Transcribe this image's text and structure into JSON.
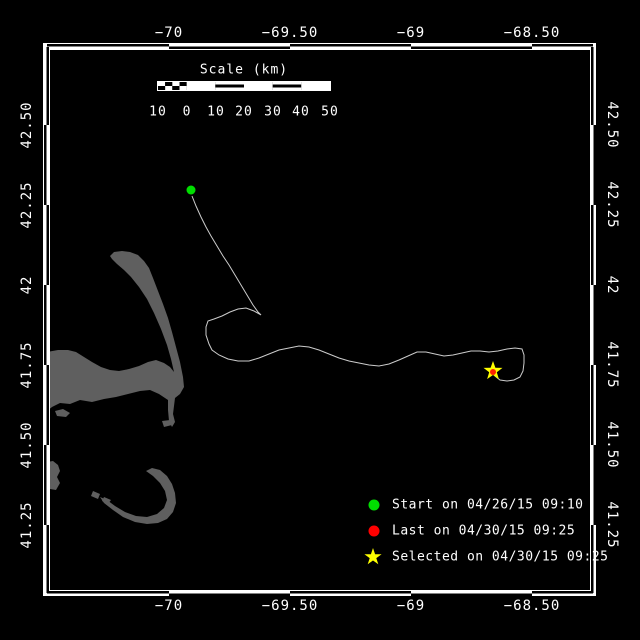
{
  "axes": {
    "lon_labels": [
      "−70",
      "−69.50",
      "−69",
      "−68.50"
    ],
    "lat_labels": [
      "42.50",
      "42.25",
      "42",
      "41.75",
      "41.50",
      "41.25"
    ]
  },
  "scale_bar": {
    "title": "Scale (km)",
    "tick_labels": [
      "10",
      "0",
      "10",
      "20",
      "30",
      "40",
      "50"
    ]
  },
  "legend": {
    "items": [
      {
        "marker": "start-dot",
        "label": "Start on 04/26/15 09:10",
        "color": "#00dd00"
      },
      {
        "marker": "last-dot",
        "label": "Last on 04/30/15 09:25",
        "color": "#ff0000"
      },
      {
        "marker": "selected-star",
        "label": "Selected on 04/30/15 09:25",
        "color": "#ffff00"
      }
    ]
  },
  "colors": {
    "background": "#000000",
    "frame": "#ffffff",
    "land": "#5f5f5f",
    "track": "#cccccc",
    "start": "#00dd00",
    "last": "#ff0000",
    "selected": "#ffff00"
  },
  "chart_data": {
    "type": "map",
    "extent": {
      "lon_min": -70.5,
      "lon_max": -68.25,
      "lat_min": 41.04,
      "lat_max": 42.74
    },
    "lon_ticks": [
      -70,
      -69.5,
      -69,
      -68.5
    ],
    "lat_ticks": [
      42.5,
      42.25,
      42,
      41.75,
      41.5,
      41.25
    ],
    "markers": [
      {
        "name": "start",
        "lon": -69.91,
        "lat": 42.3,
        "time": "04/26/15 09:10",
        "color": "green",
        "px": [
          191,
          190
        ]
      },
      {
        "name": "last",
        "lon": -68.66,
        "lat": 41.73,
        "time": "04/30/15 09:25",
        "color": "red",
        "px": [
          493,
          372
        ]
      },
      {
        "name": "selected",
        "lon": -68.66,
        "lat": 41.73,
        "time": "04/30/15 09:25",
        "color": "yellow",
        "px": [
          493,
          371
        ]
      }
    ],
    "track_px": [
      [
        192,
        196
      ],
      [
        196,
        206
      ],
      [
        201,
        217
      ],
      [
        206,
        227
      ],
      [
        211,
        236
      ],
      [
        217,
        246
      ],
      [
        223,
        256
      ],
      [
        229,
        265
      ],
      [
        235,
        275
      ],
      [
        241,
        285
      ],
      [
        247,
        295
      ],
      [
        253,
        305
      ],
      [
        258,
        312
      ],
      [
        261,
        315
      ],
      [
        254,
        311
      ],
      [
        246,
        308
      ],
      [
        238,
        309
      ],
      [
        230,
        312
      ],
      [
        222,
        316
      ],
      [
        214,
        319
      ],
      [
        208,
        321
      ],
      [
        206,
        327
      ],
      [
        206,
        335
      ],
      [
        209,
        344
      ],
      [
        212,
        350
      ],
      [
        219,
        355
      ],
      [
        228,
        359
      ],
      [
        238,
        361
      ],
      [
        249,
        361
      ],
      [
        259,
        358
      ],
      [
        269,
        354
      ],
      [
        279,
        350
      ],
      [
        289,
        348
      ],
      [
        299,
        346
      ],
      [
        309,
        347
      ],
      [
        319,
        350
      ],
      [
        329,
        354
      ],
      [
        339,
        358
      ],
      [
        349,
        361
      ],
      [
        359,
        363
      ],
      [
        369,
        365
      ],
      [
        379,
        366
      ],
      [
        389,
        364
      ],
      [
        399,
        360
      ],
      [
        408,
        356
      ],
      [
        417,
        352
      ],
      [
        426,
        352
      ],
      [
        435,
        354
      ],
      [
        444,
        356
      ],
      [
        453,
        355
      ],
      [
        462,
        353
      ],
      [
        471,
        351
      ],
      [
        480,
        351
      ],
      [
        489,
        352
      ],
      [
        498,
        351
      ],
      [
        507,
        349
      ],
      [
        515,
        348
      ],
      [
        522,
        349
      ],
      [
        524,
        355
      ],
      [
        524,
        363
      ],
      [
        523,
        371
      ],
      [
        520,
        377
      ],
      [
        514,
        380
      ],
      [
        507,
        381
      ],
      [
        500,
        380
      ],
      [
        495,
        376
      ],
      [
        493,
        373
      ]
    ],
    "land_polygons_px": [
      [
        [
          47,
          352
        ],
        [
          58,
          350
        ],
        [
          68,
          350
        ],
        [
          76,
          352
        ],
        [
          84,
          357
        ],
        [
          92,
          362
        ],
        [
          101,
          367
        ],
        [
          110,
          370
        ],
        [
          119,
          371
        ],
        [
          129,
          369
        ],
        [
          139,
          366
        ],
        [
          148,
          362
        ],
        [
          156,
          360
        ],
        [
          164,
          363
        ],
        [
          170,
          367
        ],
        [
          174,
          372
        ],
        [
          171,
          359
        ],
        [
          167,
          345
        ],
        [
          161,
          329
        ],
        [
          154,
          313
        ],
        [
          147,
          299
        ],
        [
          139,
          287
        ],
        [
          131,
          277
        ],
        [
          124,
          270
        ],
        [
          117,
          264
        ],
        [
          112,
          259
        ],
        [
          110,
          256
        ],
        [
          114,
          252
        ],
        [
          122,
          251
        ],
        [
          130,
          252
        ],
        [
          138,
          255
        ],
        [
          144,
          261
        ],
        [
          149,
          268
        ],
        [
          153,
          278
        ],
        [
          158,
          291
        ],
        [
          163,
          304
        ],
        [
          168,
          318
        ],
        [
          172,
          332
        ],
        [
          176,
          347
        ],
        [
          180,
          362
        ],
        [
          183,
          377
        ],
        [
          184,
          387
        ],
        [
          180,
          394
        ],
        [
          175,
          398
        ],
        [
          174,
          406
        ],
        [
          173,
          414
        ],
        [
          175,
          422
        ],
        [
          172,
          427
        ],
        [
          169,
          421
        ],
        [
          168,
          410
        ],
        [
          168,
          400
        ],
        [
          159,
          394
        ],
        [
          150,
          390
        ],
        [
          140,
          391
        ],
        [
          128,
          394
        ],
        [
          116,
          397
        ],
        [
          104,
          399
        ],
        [
          92,
          402
        ],
        [
          80,
          400
        ],
        [
          70,
          404
        ],
        [
          60,
          403
        ],
        [
          52,
          407
        ],
        [
          47,
          411
        ]
      ],
      [
        [
          160,
          470
        ],
        [
          167,
          476
        ],
        [
          172,
          484
        ],
        [
          175,
          493
        ],
        [
          176,
          503
        ],
        [
          173,
          512
        ],
        [
          167,
          519
        ],
        [
          158,
          523
        ],
        [
          147,
          524
        ],
        [
          135,
          522
        ],
        [
          123,
          517
        ],
        [
          113,
          510
        ],
        [
          104,
          503
        ],
        [
          100,
          497
        ],
        [
          107,
          500
        ],
        [
          115,
          506
        ],
        [
          125,
          512
        ],
        [
          136,
          516
        ],
        [
          147,
          517
        ],
        [
          157,
          514
        ],
        [
          164,
          508
        ],
        [
          167,
          500
        ],
        [
          165,
          491
        ],
        [
          160,
          483
        ],
        [
          153,
          476
        ],
        [
          146,
          471
        ],
        [
          152,
          468
        ]
      ],
      [
        [
          47,
          462
        ],
        [
          53,
          461
        ],
        [
          58,
          465
        ],
        [
          60,
          471
        ],
        [
          57,
          477
        ],
        [
          60,
          483
        ],
        [
          56,
          490
        ],
        [
          50,
          489
        ],
        [
          47,
          485
        ]
      ],
      [
        [
          55,
          411
        ],
        [
          63,
          409
        ],
        [
          70,
          413
        ],
        [
          66,
          417
        ],
        [
          57,
          416
        ]
      ],
      [
        [
          93,
          491
        ],
        [
          100,
          494
        ],
        [
          98,
          499
        ],
        [
          91,
          496
        ]
      ],
      [
        [
          104,
          497
        ],
        [
          111,
          500
        ],
        [
          108,
          504
        ],
        [
          102,
          501
        ]
      ],
      [
        [
          162,
          421
        ],
        [
          170,
          420
        ],
        [
          172,
          425
        ],
        [
          164,
          427
        ]
      ]
    ]
  }
}
